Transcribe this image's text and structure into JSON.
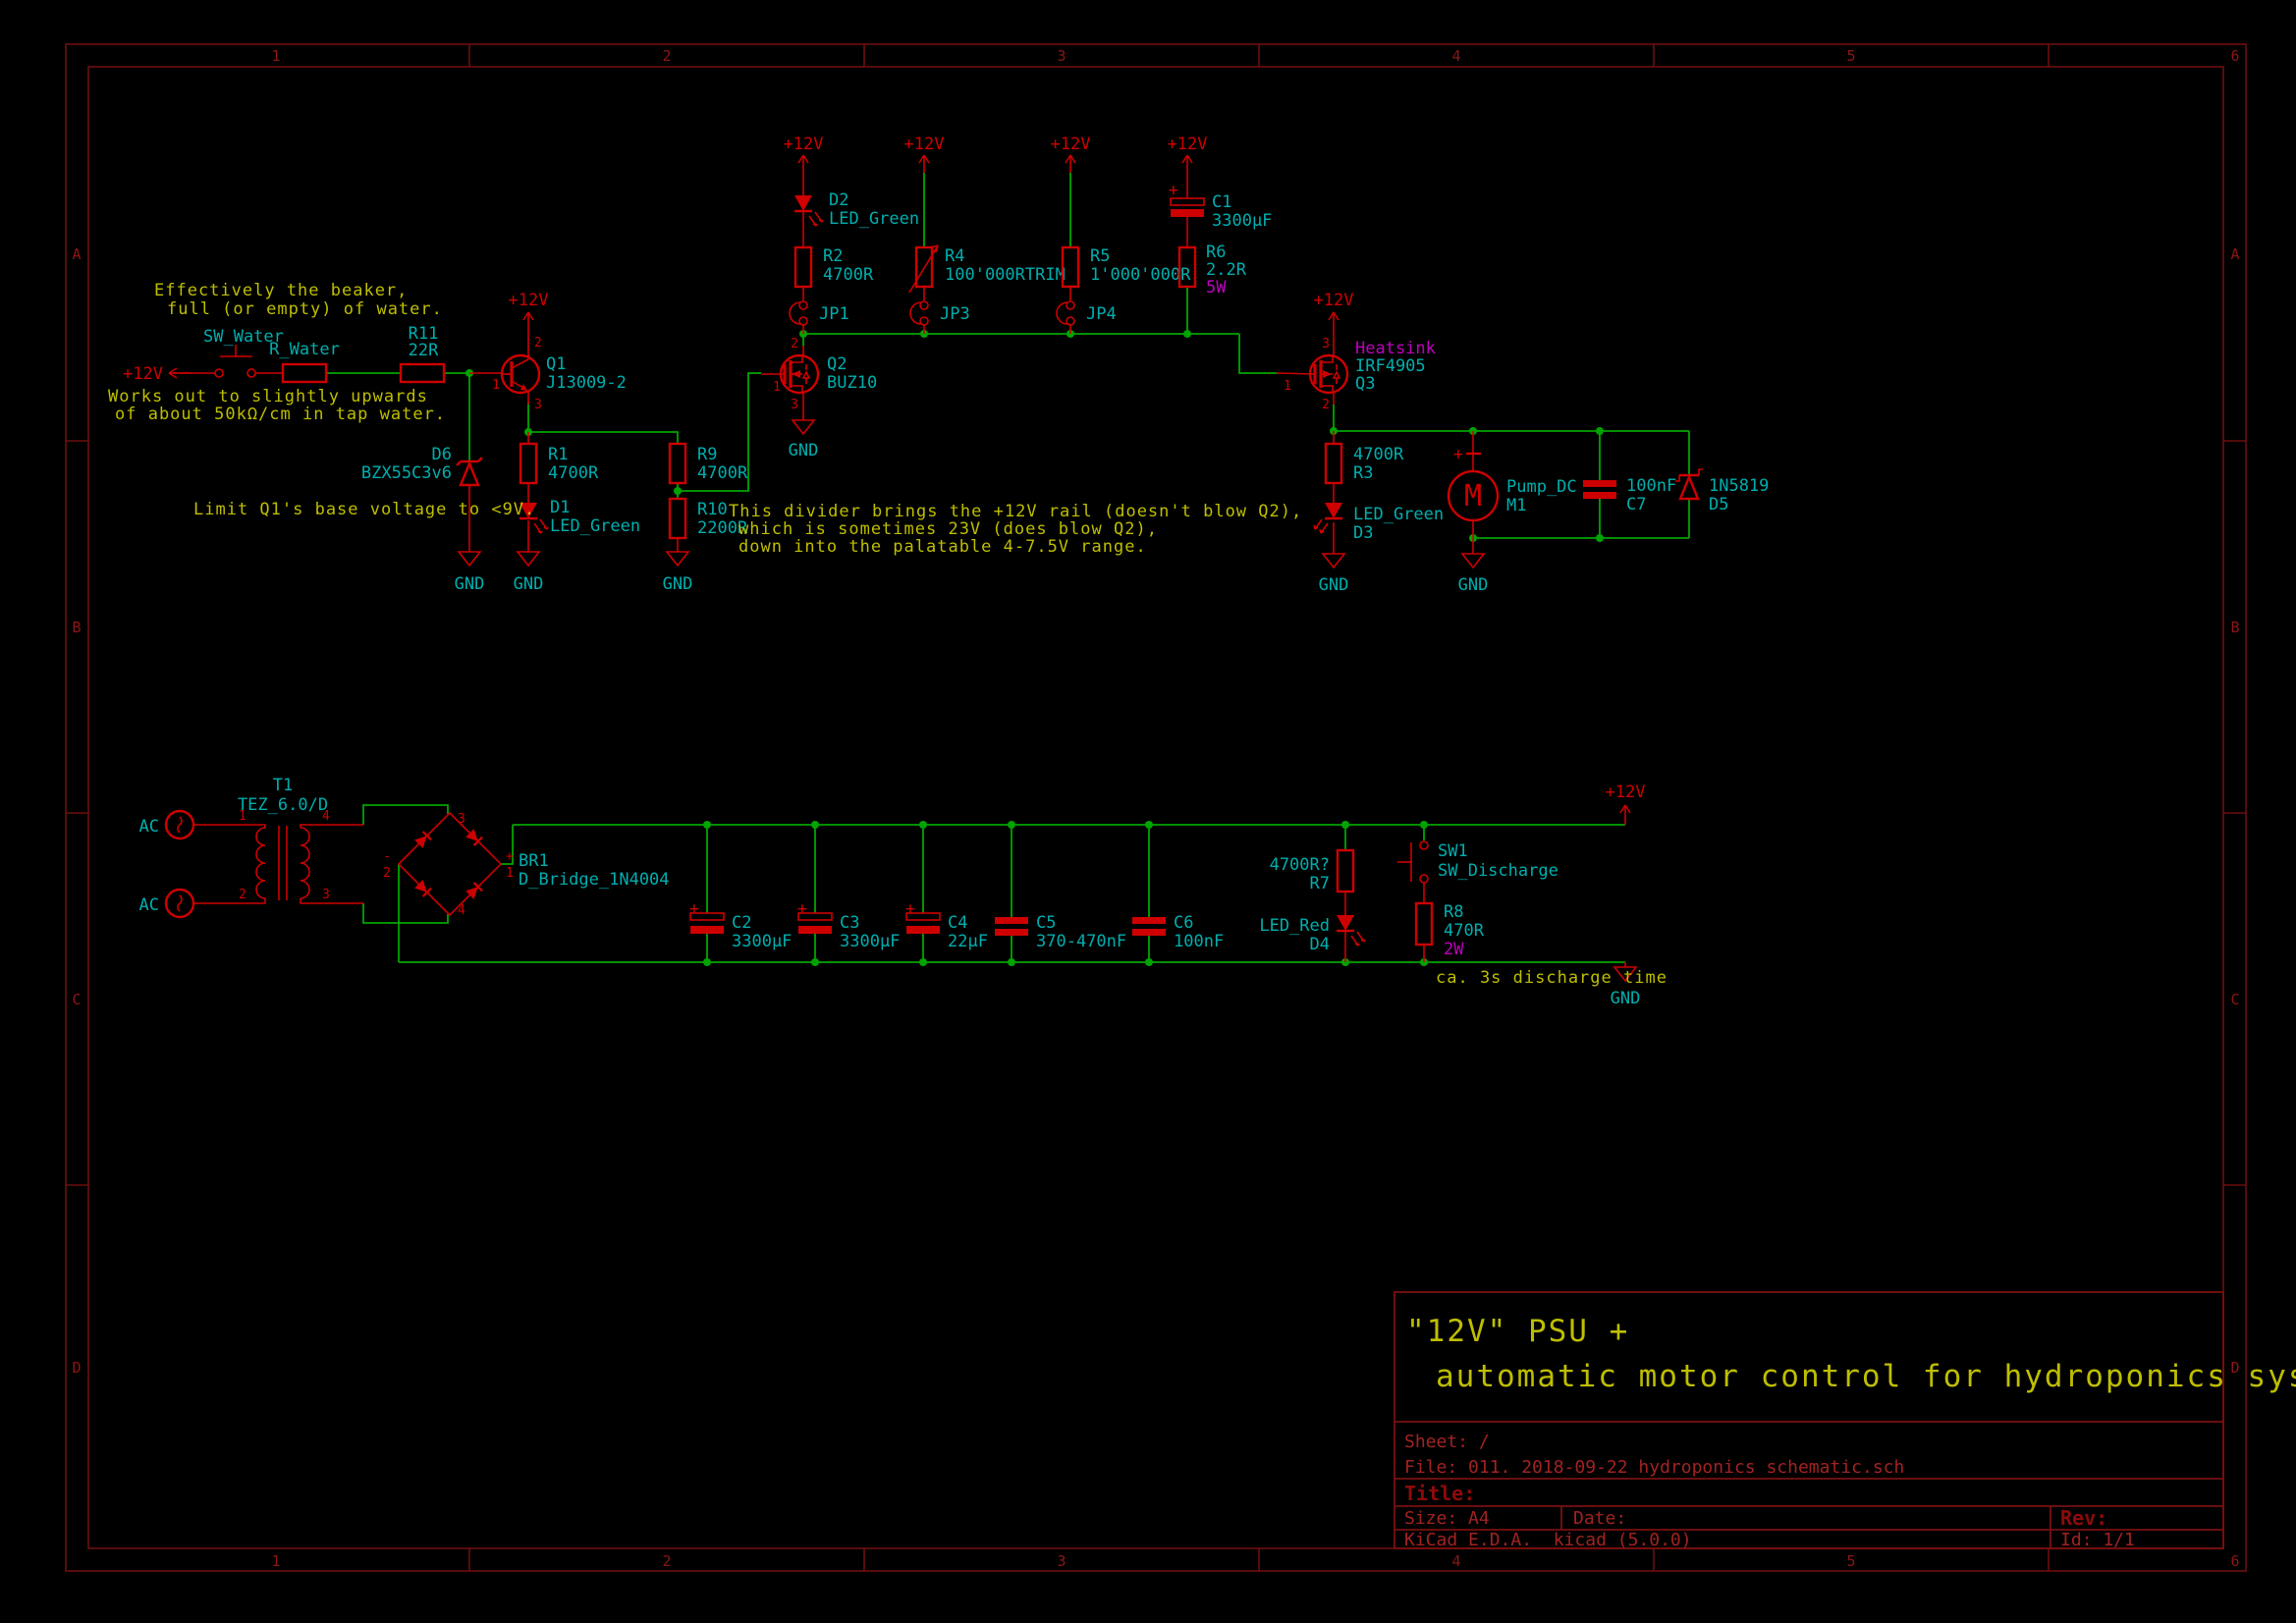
{
  "title_block": {
    "comment_line1": "\"12V\" PSU +",
    "comment_line2": "automatic motor control for hydroponics systems",
    "sheet": "Sheet: /",
    "file": "File: 011. 2018-09-22 hydroponics schematic.sch",
    "title_label": "Title:",
    "size": "Size: A4",
    "date": "Date:",
    "rev": "Rev:",
    "kicad": "KiCad E.D.A.  kicad (5.0.0)",
    "id": "Id: 1/1"
  },
  "border": {
    "cols": [
      "1",
      "2",
      "3",
      "4",
      "5",
      "6"
    ],
    "rows": [
      "A",
      "B",
      "C",
      "D"
    ]
  },
  "power": {
    "p12": "+12V",
    "gnd": "GND",
    "ac": "AC",
    "plus": "+",
    "minus": "-"
  },
  "comments": {
    "beaker1": "Effectively the beaker,",
    "beaker2": "full (or empty) of water.",
    "tapwater1": "Works out to slightly upwards",
    "tapwater2": "of about 50kΩ/cm in tap water.",
    "limit": "Limit Q1's base voltage to <9V.",
    "divider1": "This divider brings the +12V rail (doesn't blow Q2),",
    "divider2": "which is sometimes 23V (does blow Q2),",
    "divider3": "down into the palatable 4-7.5V range.",
    "discharge": "ca. 3s discharge time"
  },
  "components": {
    "sw_water": {
      "ref": "SW_Water"
    },
    "r_water": {
      "ref": "R_Water"
    },
    "r11": {
      "ref": "R11",
      "value": "22R"
    },
    "q1": {
      "ref": "Q1",
      "value": "J13009-2",
      "pins": [
        "1",
        "2",
        "3"
      ]
    },
    "d6": {
      "ref": "D6",
      "value": "BZX55C3v6"
    },
    "r1": {
      "ref": "R1",
      "value": "4700R"
    },
    "d1": {
      "ref": "D1",
      "value": "LED_Green"
    },
    "r9": {
      "ref": "R9",
      "value": "4700R"
    },
    "r10": {
      "ref": "R10",
      "value": "2200R"
    },
    "d2": {
      "ref": "D2",
      "value": "LED_Green"
    },
    "r2": {
      "ref": "R2",
      "value": "4700R"
    },
    "jp1": {
      "ref": "JP1"
    },
    "r4": {
      "ref": "R4",
      "value": "100'000RTRIM"
    },
    "jp3": {
      "ref": "JP3"
    },
    "r5": {
      "ref": "R5",
      "value": "1'000'000R"
    },
    "jp4": {
      "ref": "JP4"
    },
    "c1": {
      "ref": "C1",
      "value": "3300µF"
    },
    "r6": {
      "ref": "R6",
      "value": "2.2R",
      "power": "5W"
    },
    "q2": {
      "ref": "Q2",
      "value": "BUZ10",
      "pins": [
        "1",
        "2",
        "3"
      ]
    },
    "q3": {
      "ref": "Q3",
      "value": "IRF4905",
      "note": "Heatsink",
      "pins": [
        "1",
        "2",
        "3"
      ]
    },
    "r3": {
      "ref": "R3",
      "value": "4700R"
    },
    "d3": {
      "ref": "D3",
      "value": "LED_Green"
    },
    "m1": {
      "ref": "M1",
      "value": "Pump_DC",
      "glyph": "M"
    },
    "c7": {
      "ref": "C7",
      "value": "100nF"
    },
    "d5": {
      "ref": "D5",
      "value": "1N5819"
    },
    "t1": {
      "ref": "T1",
      "value": "TEZ_6.0/D",
      "pins": [
        "1",
        "2",
        "3",
        "4"
      ]
    },
    "br1": {
      "ref": "BR1",
      "value": "D_Bridge_1N4004",
      "pins": [
        "1",
        "2",
        "3",
        "4"
      ]
    },
    "c2": {
      "ref": "C2",
      "value": "3300µF"
    },
    "c3": {
      "ref": "C3",
      "value": "3300µF"
    },
    "c4": {
      "ref": "C4",
      "value": "22µF"
    },
    "c5": {
      "ref": "C5",
      "value": "370-470nF"
    },
    "c6": {
      "ref": "C6",
      "value": "100nF"
    },
    "r7": {
      "ref": "R7",
      "value": "4700R?"
    },
    "d4": {
      "ref": "D4",
      "value": "LED_Red"
    },
    "sw1": {
      "ref": "SW1",
      "value": "SW_Discharge"
    },
    "r8": {
      "ref": "R8",
      "value": "470R",
      "power": "2W"
    }
  },
  "colors": {
    "wire": "#00A400",
    "component": "#CE0000",
    "label": "#00AEAE",
    "comment": "#BEBE00",
    "attribute": "#BE00BE",
    "frame": "#6E0E0E",
    "background": "#000000"
  }
}
